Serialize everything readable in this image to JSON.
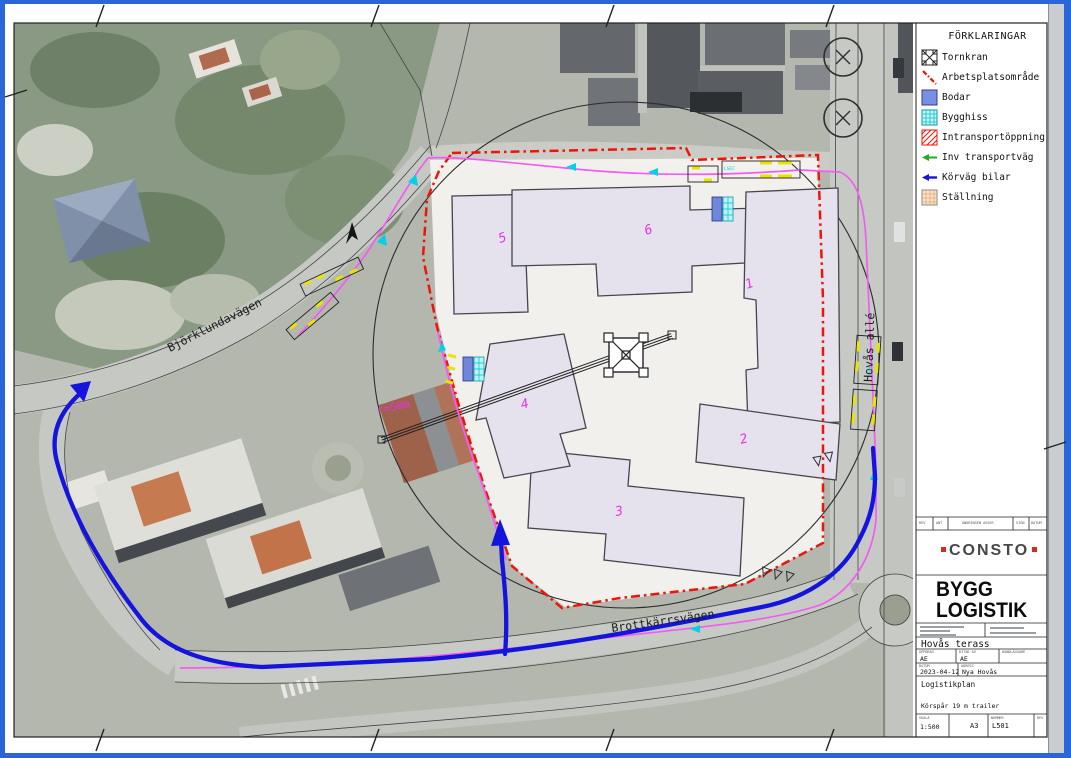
{
  "legend": {
    "title": "FÖRKLARINGAR",
    "items": [
      {
        "label": "Tornkran",
        "symbol": "tower-crane"
      },
      {
        "label": "Arbetsplatsområde",
        "symbol": "red-dashdot-line",
        "color": "#ee1408"
      },
      {
        "label": "Bodar",
        "symbol": "blue-square",
        "color": "#7b8fe0"
      },
      {
        "label": "Bygghiss",
        "symbol": "cyan-grid-square",
        "color": "#00c0cc"
      },
      {
        "label": "Intransportöppning",
        "symbol": "red-hatch-square",
        "color": "#ee1408"
      },
      {
        "label": "Inv transportväg",
        "symbol": "green-arrow",
        "color": "#1fae1f"
      },
      {
        "label": "Körväg bilar",
        "symbol": "blue-arrow",
        "color": "#1414dd"
      },
      {
        "label": "Ställning",
        "symbol": "tan-grid-square",
        "color": "#e2a977"
      }
    ]
  },
  "map": {
    "streets": {
      "northwest": "Björklundavägen",
      "south": "Brottkärrsvägen",
      "east": "Hovås allé"
    },
    "building_labels": {
      "b1": "1",
      "b2": "2",
      "b3": "3",
      "b4": "4",
      "b5": "5",
      "b6": "6"
    },
    "crane_radius_label": "r=50m",
    "trailer_code": "LSEC"
  },
  "title_block": {
    "revision_columns": [
      "REV",
      "ANT",
      "ÄNDRINGEN AVSER",
      "SIGN",
      "DATUM"
    ],
    "consto_logo": "CONSTO",
    "brand_line1": "BYGG",
    "brand_line2": "LOGISTIK",
    "project_name": "Hovås terass",
    "fields": {
      "col1_label": "UPPDRAG",
      "col1_value": "AE",
      "col2_label": "RITAD AV",
      "col2_value": "AE",
      "col3_label": "HANDLÄGGARE",
      "col3_value": ""
    },
    "date_label": "DATUM",
    "date_value": "2023-04-12",
    "area_label": "ADRESS",
    "area_value": "Nya Hovås",
    "content_title": "Logistikplan",
    "note": "Körspår 19 m trailer",
    "scale_label": "SKALA",
    "scale_value": "1:500",
    "format_value": "A3",
    "number_label": "NUMMER",
    "number_value": "L501",
    "rev_label": "REV"
  },
  "colors": {
    "boundary_red": "#ee1408",
    "route_blue": "#1414dd",
    "path_magenta": "#f25cf2",
    "label_magenta": "#e832e8",
    "arrow_cyan": "#00d2e6",
    "frame_blue": "#2b66d9"
  }
}
